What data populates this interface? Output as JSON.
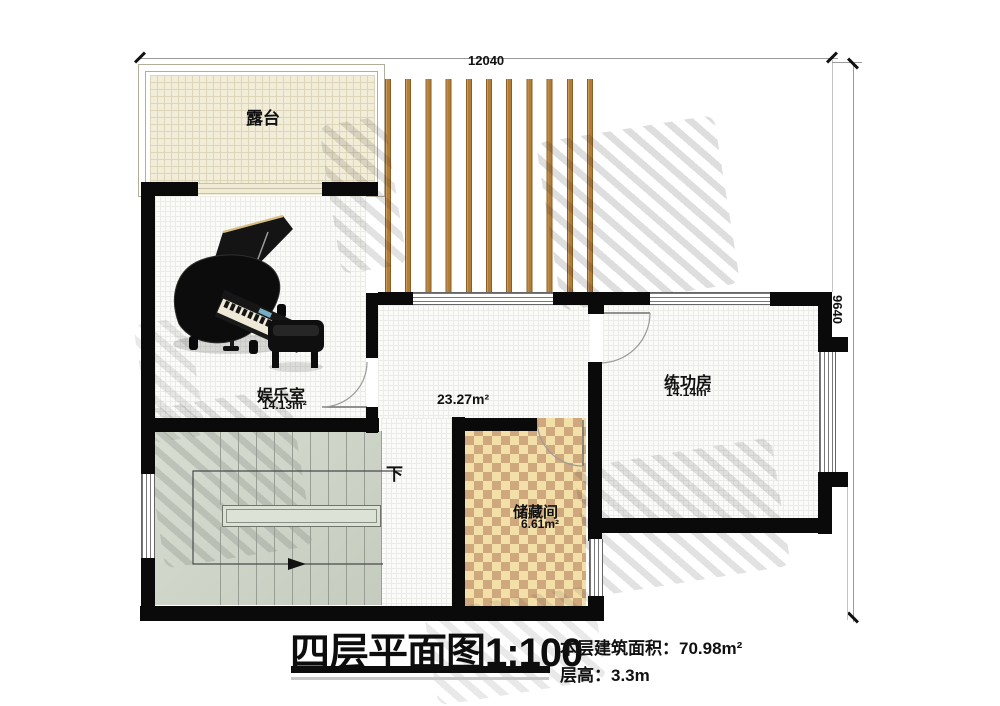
{
  "dimensions": {
    "width_label": "12040",
    "height_label": "9640"
  },
  "rooms": {
    "terrace": {
      "name": "露台"
    },
    "entertainment": {
      "name": "娱乐室",
      "area": "14.13m²"
    },
    "hall": {
      "area": "23.27m²"
    },
    "practice": {
      "name": "练功房",
      "area": "14.14m²"
    },
    "storage": {
      "name": "储藏间",
      "area": "6.61m²"
    }
  },
  "stairs": {
    "direction": "下"
  },
  "titleblock": {
    "title": "四层平面图",
    "scale": "1:100",
    "area_label": "本层建筑面积：",
    "area_value": "70.98m²",
    "floor_height_label": "层高：",
    "floor_height_value": "3.3m"
  },
  "colors": {
    "wall": "#0a0a0a",
    "wood_slat": "#b27c39",
    "terrace_floor": "#f2edd8",
    "checker_light": "#f3dfa8",
    "checker_dark": "#cfa87d",
    "stair_floor": "#cdd4c7",
    "room_floor": "#fbfbf9"
  }
}
